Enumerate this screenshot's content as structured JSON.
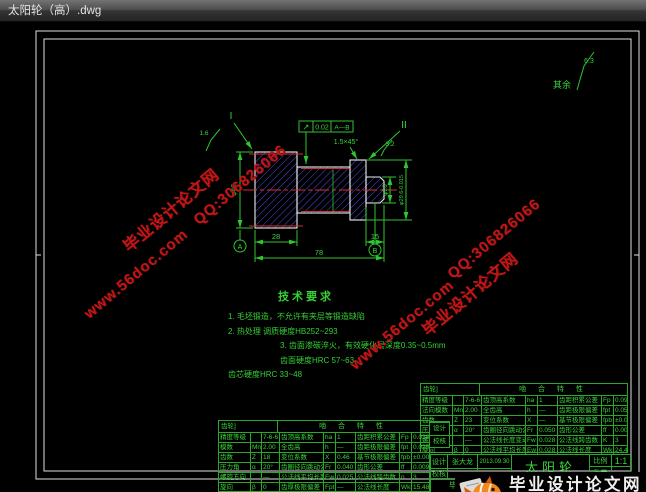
{
  "window": {
    "title": "太阳轮（高）.dwg"
  },
  "drawing": {
    "rest_note": {
      "label": "其余",
      "value": "6.3"
    },
    "ann": {
      "section_i": "I",
      "section_ii": "II",
      "rough_left": "1.6",
      "rough_right": "3.2",
      "chamfer": "1.5×45°",
      "runout_symbol": "↗",
      "runout_value": "0.02",
      "runout_datum": "A—B",
      "datum_a": "A",
      "datum_b": "B"
    },
    "dims": {
      "gear_width": "28",
      "journal_width": "15",
      "total_width": "78",
      "gear_dia": "φ46",
      "journal_dia": "φ26",
      "rim_dia": "φ29.6-0.015"
    },
    "tech": {
      "title": "技术要求",
      "lines": [
        "1. 毛坯锻造，不允许有夹层等锻造缺陷",
        "2. 热处理  调质硬度HB252~293",
        "3. 齿面渗碳淬火，有效硬化层深度0.35~0.5mm",
        "齿面硬度HRC 57~63",
        "齿芯硬度HRC 33~48"
      ]
    }
  },
  "tables": {
    "a": {
      "corner": "齿轮]",
      "title": "啮 合 特 性",
      "rows": [
        [
          "精度等级",
          "",
          "7-6-6",
          "齿顶高系数",
          "ha",
          "1",
          "齿距积累公差",
          "Fp",
          "0.090"
        ],
        [
          "法向模数",
          "Mn",
          "2.00",
          "全齿高",
          "h",
          "—",
          "齿距极限偏差",
          "fpt",
          "0.050"
        ],
        [
          "齿数",
          "Z",
          "23",
          "变位系数",
          "X",
          "—",
          "基节极限偏差",
          "fpb",
          "±0.005"
        ],
        [
          "压力角",
          "α",
          "20°",
          "齿圈径向跳动公差",
          "Fr",
          "0.050",
          "齿形公差",
          "ff",
          "0.009"
        ],
        [
          "螺旋方向",
          "",
          "—",
          "公法线长度变动公差",
          "Fw",
          "0.028",
          "公法线跨齿数",
          "K",
          "3"
        ],
        [
          "旋向",
          "β",
          "0",
          "公法线平均长度偏差",
          "Ew",
          "0.028",
          "公法线长度",
          "Wk",
          "24.46"
        ]
      ]
    },
    "b": {
      "corner": "齿轮]",
      "title": "啮 合 特 性",
      "rows": [
        [
          "精度等级",
          "",
          "7-6-6",
          "齿顶高系数",
          "ha",
          "1",
          "齿距积累公差",
          "Fp",
          "0.038"
        ],
        [
          "模数",
          "Mn",
          "2.00",
          "全齿高",
          "h",
          "—",
          "齿距极限偏差",
          "fpt",
          "0.025"
        ],
        [
          "齿数",
          "Z",
          "18",
          "变位系数",
          "X",
          "0.46",
          "基节极限偏差",
          "fpb",
          "±0.005"
        ],
        [
          "压力角",
          "α",
          "20°",
          "齿圈径向跳动公差",
          "Fr",
          "0.040",
          "齿形公差",
          "ff",
          "0.009"
        ],
        [
          "螺旋方向",
          "",
          "—",
          "公法线平均长度偏差",
          "Ew",
          "0.025",
          "公法线跨齿数",
          "n",
          "3"
        ],
        [
          "旋向",
          "β",
          "0",
          "齿厚极限偏差",
          "Fpt",
          "—",
          "公法线长度",
          "Wkn",
          "15.48"
        ]
      ]
    }
  },
  "sig": {
    "rows": [
      "设计",
      "校核"
    ]
  },
  "title_block": {
    "design_label": "设计",
    "designer": "张大龙",
    "date": "2013.09.30",
    "check_label": "校核",
    "part_name": "太阳轮",
    "scale_label": "比例",
    "scale_value": "1:1",
    "qty_label": "数量",
    "project": "毕业设计"
  },
  "watermarks": {
    "site": "毕业设计论文网",
    "qq": "QQ:306826066",
    "url": "www.56doc.com"
  },
  "logo": {
    "site": "毕业设计论文网",
    "url_parts": [
      "www",
      "56doc",
      "com"
    ],
    "dot": "."
  },
  "colors": {
    "cad_green": "#3ad43a",
    "hatch_blue": "#4b4bdc",
    "centerline_red": "#d03030",
    "watermark_red": "#c01616",
    "logo_orange": "#f5871f"
  }
}
